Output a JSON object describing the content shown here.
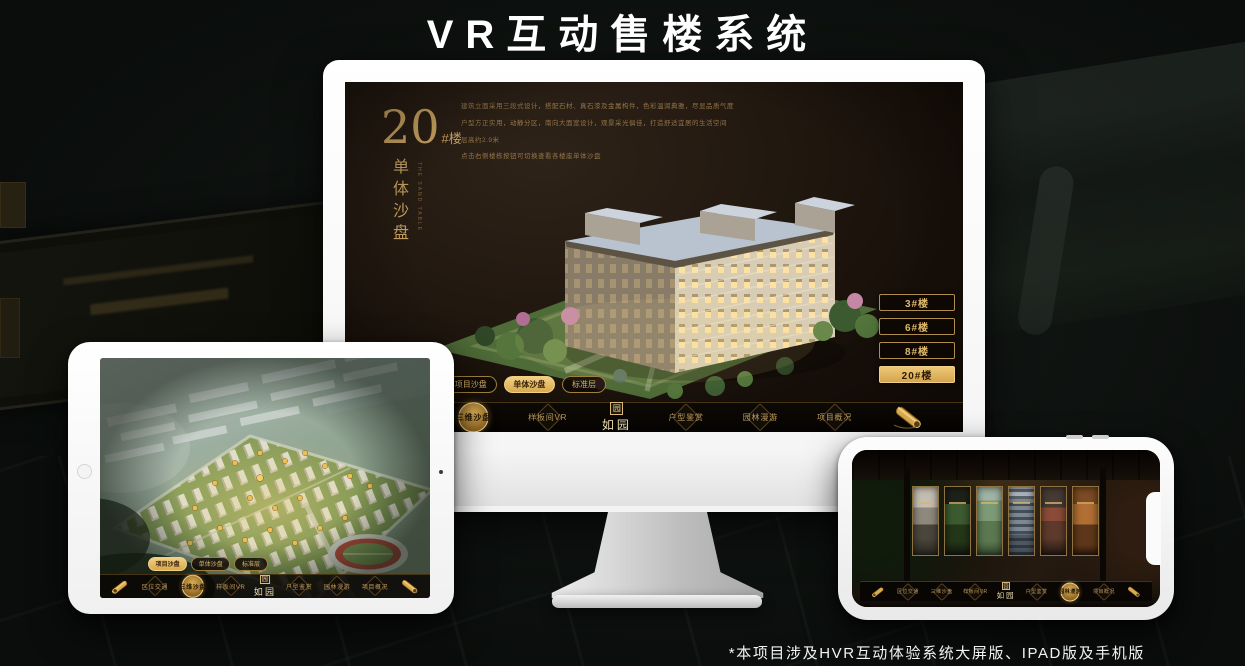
{
  "page": {
    "title": "VR互动售楼系统",
    "footnote": "*本项目涉及HVR互动体验系统大屏版、IPAD版及手机版"
  },
  "brand": {
    "name": "如园",
    "seal": "园"
  },
  "colors": {
    "gold": "#c9a35f",
    "gold_bright": "#e8c06e",
    "screen_bg": "#1c140d",
    "active_tab": "#e2b567"
  },
  "monitor": {
    "screen": {
      "building_no": "20",
      "building_no_suffix": "#楼",
      "vertical_title": "单体沙盘",
      "vertical_caption": "THE SAND TABLE",
      "description_lines": [
        "建筑立面采用三段式设计，搭配石材、真石漆及金属构件，色彩温润典雅，尽显品质气度",
        "户型方正实用，动静分区，南向大面宽设计，观景采光俱佳，打造舒适宜居的生活空间",
        "层高约2.9米",
        "点击右侧楼栋按钮可切换查看各楼座单体沙盘"
      ],
      "floor_buttons": [
        {
          "label": "3#楼"
        },
        {
          "label": "6#楼"
        },
        {
          "label": "8#楼"
        },
        {
          "label": "20#楼"
        }
      ],
      "tabs": [
        {
          "label": "项目沙盘"
        },
        {
          "label": "单体沙盘"
        },
        {
          "label": "标准层"
        }
      ],
      "nav": {
        "items": [
          {
            "label": "区位交通"
          },
          {
            "label": "三维沙盘"
          },
          {
            "label": "样板间VR"
          },
          {
            "label": "户型鉴赏"
          },
          {
            "label": "园林漫游"
          },
          {
            "label": "项目概况"
          }
        ]
      }
    }
  },
  "ipad": {
    "tabs": [
      {
        "label": "项目沙盘"
      },
      {
        "label": "单体沙盘"
      },
      {
        "label": "标准层"
      }
    ],
    "nav": {
      "items": [
        {
          "label": "区位交通"
        },
        {
          "label": "三维沙盘"
        },
        {
          "label": "样板间VR"
        },
        {
          "label": "户型鉴赏"
        },
        {
          "label": "园林漫游"
        },
        {
          "label": "项目概况"
        }
      ]
    }
  },
  "phone": {
    "nav": {
      "items": [
        {
          "label": "区位交通"
        },
        {
          "label": "三维沙盘"
        },
        {
          "label": "样板间VR"
        },
        {
          "label": "户型鉴赏"
        },
        {
          "label": "园林漫游"
        },
        {
          "label": "项目概况"
        }
      ]
    }
  }
}
